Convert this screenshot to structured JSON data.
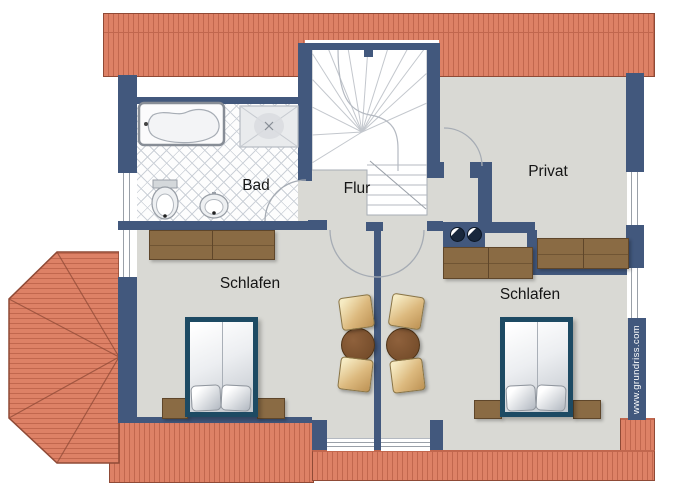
{
  "floorplan": {
    "rooms": [
      {
        "id": "bad",
        "label": "Bad"
      },
      {
        "id": "flur",
        "label": "Flur"
      },
      {
        "id": "privat",
        "label": "Privat"
      },
      {
        "id": "schlafen_west",
        "label": "Schlafen"
      },
      {
        "id": "schlafen_ost",
        "label": "Schlafen"
      }
    ],
    "watermark": "www.grundriss.com"
  },
  "colors": {
    "roof": "#dd8166",
    "roofline": "#c1674e",
    "roofedge": "#8f4a36",
    "wall": "#42587d",
    "floor": "#d9d9d4",
    "tileline": "#ccd1d8",
    "wood": "#8a6b44",
    "wooddark": "#5f462a",
    "bedframe": "#1d4a63",
    "chairlight": "#f6ebc3",
    "chairdark": "#bd9254",
    "table": "#6e4726",
    "labelcolor": "#151515",
    "watermarkcolor": "#ffffff",
    "arc": "#a6acb4"
  }
}
